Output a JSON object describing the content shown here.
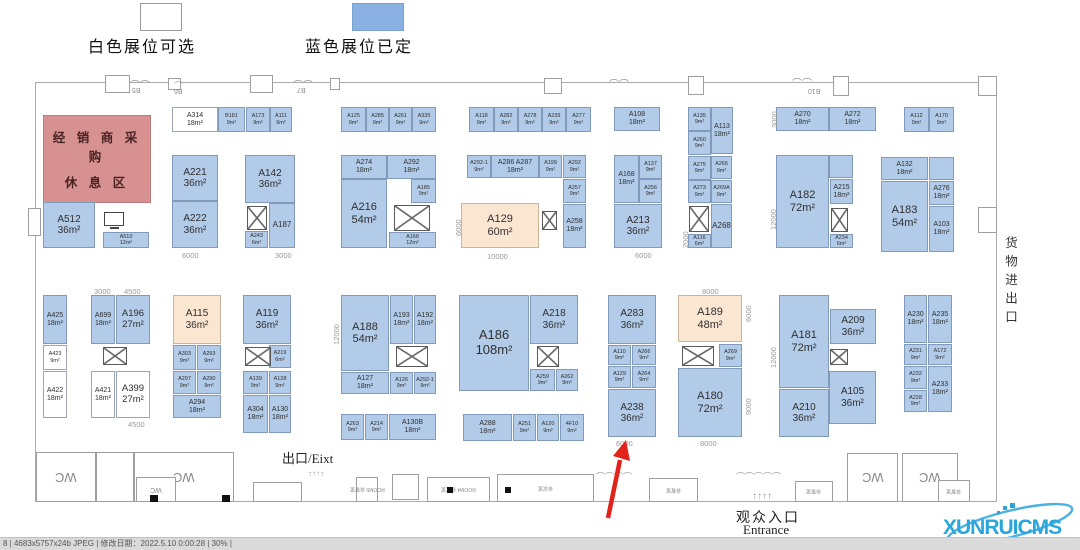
{
  "legend": {
    "available_label": "白色展位可选",
    "booked_label": "蓝色展位已定"
  },
  "colors": {
    "booked": "#b2cbe8",
    "available": "#ffffff",
    "special": "#fbe6d2",
    "rest_area": "#d79191",
    "arrow": "#e0241b",
    "logo": "#2ba6dc"
  },
  "rest_area": {
    "line1": "经 销 商 采 购",
    "line2": "休 息 区"
  },
  "texts": {
    "exit": "出口/Eixt",
    "entrance_cn": "观众入口",
    "entrance_en": "Entrance",
    "cargo": "货物进出口"
  },
  "logo": {
    "text": "XUNRUICMS"
  },
  "statusbar": {
    "text": "8 | 4683x5757x24b JPEG | 修改日期：2022.5.10 0:00:28 | 30% |"
  },
  "booths": [
    {
      "id": "A314",
      "a": "18m²",
      "x": 172,
      "y": 107,
      "w": 46,
      "h": 25,
      "t": "available"
    },
    {
      "id": "B181",
      "a": "9m²",
      "x": 218,
      "y": 107,
      "w": 27,
      "h": 25
    },
    {
      "id": "A173",
      "a": "9m²",
      "x": 246,
      "y": 107,
      "w": 24,
      "h": 25
    },
    {
      "id": "A111",
      "a": "9m²",
      "x": 270,
      "y": 107,
      "w": 22,
      "h": 25
    },
    {
      "id": "A125",
      "a": "9m²",
      "x": 341,
      "y": 107,
      "w": 25,
      "h": 25
    },
    {
      "id": "A285",
      "a": "9m²",
      "x": 366,
      "y": 107,
      "w": 23,
      "h": 25
    },
    {
      "id": "A261",
      "a": "9m²",
      "x": 389,
      "y": 107,
      "w": 23,
      "h": 25
    },
    {
      "id": "A335",
      "a": "9m²",
      "x": 412,
      "y": 107,
      "w": 24,
      "h": 25
    },
    {
      "id": "A118",
      "a": "9m²",
      "x": 469,
      "y": 107,
      "w": 25,
      "h": 25
    },
    {
      "id": "A282",
      "a": "9m²",
      "x": 494,
      "y": 107,
      "w": 24,
      "h": 25
    },
    {
      "id": "A278",
      "a": "9m²",
      "x": 518,
      "y": 107,
      "w": 24,
      "h": 25
    },
    {
      "id": "A239",
      "a": "9m²",
      "x": 542,
      "y": 107,
      "w": 24,
      "h": 25
    },
    {
      "id": "A277",
      "a": "9m²",
      "x": 566,
      "y": 107,
      "w": 25,
      "h": 25
    },
    {
      "id": "A108",
      "a": "18m²",
      "x": 614,
      "y": 107,
      "w": 46,
      "h": 24
    },
    {
      "id": "A135",
      "a": "9m²",
      "x": 688,
      "y": 107,
      "w": 23,
      "h": 24
    },
    {
      "id": "A113",
      "a": "18m²",
      "x": 711,
      "y": 107,
      "w": 22,
      "h": 47
    },
    {
      "id": "A260",
      "a": "9m²",
      "x": 688,
      "y": 131,
      "w": 23,
      "h": 24
    },
    {
      "id": "A270",
      "a": "18m²",
      "x": 776,
      "y": 107,
      "w": 53,
      "h": 24
    },
    {
      "id": "A272",
      "a": "18m²",
      "x": 829,
      "y": 107,
      "w": 47,
      "h": 24
    },
    {
      "id": "A112",
      "a": "9m²",
      "x": 904,
      "y": 107,
      "w": 25,
      "h": 25
    },
    {
      "id": "A170",
      "a": "9m²",
      "x": 929,
      "y": 107,
      "w": 25,
      "h": 25
    },
    {
      "id": "A512",
      "a": "36m²",
      "x": 43,
      "y": 202,
      "w": 52,
      "h": 46
    },
    {
      "id": "A510",
      "a": "12m²",
      "x": 103,
      "y": 232,
      "w": 46,
      "h": 16
    },
    {
      "id": "A221",
      "a": "36m²",
      "x": 172,
      "y": 155,
      "w": 46,
      "h": 46
    },
    {
      "id": "A222",
      "a": "36m²",
      "x": 172,
      "y": 201,
      "w": 46,
      "h": 47
    },
    {
      "id": "A142",
      "a": "36m²",
      "x": 245,
      "y": 155,
      "w": 50,
      "h": 48
    },
    {
      "id": "A243",
      "a": "6m²",
      "x": 245,
      "y": 231,
      "w": 23,
      "h": 17
    },
    {
      "id": "A187",
      "a": "",
      "x": 269,
      "y": 203,
      "w": 26,
      "h": 45
    },
    {
      "id": "A274",
      "a": "18m²",
      "x": 341,
      "y": 155,
      "w": 46,
      "h": 24
    },
    {
      "id": "A292",
      "a": "18m²",
      "x": 387,
      "y": 155,
      "w": 49,
      "h": 24
    },
    {
      "id": "A185",
      "a": "9m²",
      "x": 411,
      "y": 179,
      "w": 25,
      "h": 24
    },
    {
      "id": "A216",
      "a": "54m²",
      "x": 341,
      "y": 179,
      "w": 46,
      "h": 69
    },
    {
      "id": "A168",
      "a": "12m²",
      "x": 389,
      "y": 232,
      "w": 47,
      "h": 16
    },
    {
      "id": "A292-1",
      "a": "9m²",
      "x": 467,
      "y": 155,
      "w": 24,
      "h": 23
    },
    {
      "id": "A286 A287",
      "a": "18m²",
      "x": 491,
      "y": 155,
      "w": 48,
      "h": 23
    },
    {
      "id": "A199",
      "a": "9m²",
      "x": 539,
      "y": 155,
      "w": 23,
      "h": 23
    },
    {
      "id": "A292",
      "a": "9m²",
      "x": 563,
      "y": 155,
      "w": 23,
      "h": 23
    },
    {
      "id": "A257",
      "a": "9m²",
      "x": 563,
      "y": 179,
      "w": 23,
      "h": 24
    },
    {
      "id": "A258",
      "a": "18m²",
      "x": 563,
      "y": 204,
      "w": 23,
      "h": 44
    },
    {
      "id": "A129",
      "a": "60m²",
      "x": 461,
      "y": 203,
      "w": 78,
      "h": 45,
      "t": "special"
    },
    {
      "id": "A168",
      "a": "18m²",
      "x": 614,
      "y": 155,
      "w": 25,
      "h": 48
    },
    {
      "id": "A137",
      "a": "9m²",
      "x": 639,
      "y": 155,
      "w": 23,
      "h": 24
    },
    {
      "id": "A256",
      "a": "9m²",
      "x": 639,
      "y": 179,
      "w": 23,
      "h": 24
    },
    {
      "id": "A213",
      "a": "36m²",
      "x": 614,
      "y": 204,
      "w": 48,
      "h": 44
    },
    {
      "id": "A275",
      "a": "9m²",
      "x": 688,
      "y": 156,
      "w": 23,
      "h": 24
    },
    {
      "id": "A265",
      "a": "9m²",
      "x": 711,
      "y": 156,
      "w": 21,
      "h": 23
    },
    {
      "id": "A273",
      "a": "9m²",
      "x": 688,
      "y": 180,
      "w": 23,
      "h": 23
    },
    {
      "id": "A269A",
      "a": "9m²",
      "x": 711,
      "y": 180,
      "w": 21,
      "h": 23
    },
    {
      "id": "A268",
      "a": "",
      "x": 711,
      "y": 204,
      "w": 21,
      "h": 44
    },
    {
      "id": "A116",
      "a": "6m²",
      "x": 688,
      "y": 234,
      "w": 23,
      "h": 14
    },
    {
      "id": "A182",
      "a": "72m²",
      "x": 776,
      "y": 155,
      "w": 53,
      "h": 93
    },
    {
      "x": 829,
      "y": 155,
      "w": 24,
      "h": 23
    },
    {
      "id": "A215",
      "a": "18m²",
      "x": 830,
      "y": 179,
      "w": 23,
      "h": 25
    },
    {
      "id": "A234",
      "a": "6m²",
      "x": 830,
      "y": 234,
      "w": 23,
      "h": 14
    },
    {
      "id": "A132",
      "a": "18m²",
      "x": 881,
      "y": 157,
      "w": 47,
      "h": 23
    },
    {
      "x": 929,
      "y": 157,
      "w": 25,
      "h": 23
    },
    {
      "id": "A276",
      "a": "18m²",
      "x": 929,
      "y": 181,
      "w": 25,
      "h": 24
    },
    {
      "id": "A183",
      "a": "54m²",
      "x": 881,
      "y": 181,
      "w": 47,
      "h": 71
    },
    {
      "id": "A103",
      "a": "18m²",
      "x": 929,
      "y": 206,
      "w": 25,
      "h": 46
    },
    {
      "id": "A425",
      "a": "18m²",
      "x": 43,
      "y": 295,
      "w": 24,
      "h": 49
    },
    {
      "id": "A423",
      "a": "9m²",
      "x": 43,
      "y": 345,
      "w": 24,
      "h": 25,
      "t": "available"
    },
    {
      "id": "A422",
      "a": "18m²",
      "x": 43,
      "y": 371,
      "w": 24,
      "h": 47,
      "t": "available"
    },
    {
      "id": "A699",
      "a": "18m²",
      "x": 91,
      "y": 295,
      "w": 24,
      "h": 49
    },
    {
      "id": "A196",
      "a": "27m²",
      "x": 116,
      "y": 295,
      "w": 34,
      "h": 49
    },
    {
      "id": "A421",
      "a": "18m²",
      "x": 91,
      "y": 371,
      "w": 24,
      "h": 47,
      "t": "available"
    },
    {
      "id": "A399",
      "a": "27m²",
      "x": 116,
      "y": 371,
      "w": 34,
      "h": 47,
      "t": "available"
    },
    {
      "id": "A115",
      "a": "36m²",
      "x": 173,
      "y": 295,
      "w": 48,
      "h": 49,
      "t": "special"
    },
    {
      "id": "A303",
      "a": "9m²",
      "x": 173,
      "y": 345,
      "w": 23,
      "h": 25
    },
    {
      "id": "A293",
      "a": "9m²",
      "x": 197,
      "y": 345,
      "w": 24,
      "h": 25
    },
    {
      "id": "A297",
      "a": "9m²",
      "x": 173,
      "y": 371,
      "w": 23,
      "h": 23
    },
    {
      "id": "A290",
      "a": "9m²",
      "x": 197,
      "y": 371,
      "w": 24,
      "h": 23
    },
    {
      "id": "A294",
      "a": "18m²",
      "x": 173,
      "y": 395,
      "w": 48,
      "h": 23
    },
    {
      "id": "A119",
      "a": "36m²",
      "x": 243,
      "y": 295,
      "w": 48,
      "h": 49
    },
    {
      "id": "A219",
      "a": "6m²",
      "x": 269,
      "y": 345,
      "w": 22,
      "h": 23
    },
    {
      "id": "A139",
      "a": "9m²",
      "x": 243,
      "y": 371,
      "w": 25,
      "h": 23
    },
    {
      "id": "A128",
      "a": "9m²",
      "x": 269,
      "y": 371,
      "w": 22,
      "h": 23
    },
    {
      "id": "A304",
      "a": "18m²",
      "x": 243,
      "y": 395,
      "w": 25,
      "h": 38
    },
    {
      "id": "A130",
      "a": "18m²",
      "x": 269,
      "y": 395,
      "w": 22,
      "h": 38
    },
    {
      "id": "A188",
      "a": "54m²",
      "x": 341,
      "y": 295,
      "w": 48,
      "h": 76
    },
    {
      "id": "A193",
      "a": "18m²",
      "x": 390,
      "y": 295,
      "w": 23,
      "h": 49
    },
    {
      "id": "A192",
      "a": "18m²",
      "x": 414,
      "y": 295,
      "w": 22,
      "h": 49
    },
    {
      "id": "A127",
      "a": "18m²",
      "x": 341,
      "y": 372,
      "w": 48,
      "h": 22
    },
    {
      "id": "A126",
      "a": "9m²",
      "x": 390,
      "y": 372,
      "w": 23,
      "h": 22
    },
    {
      "id": "A292-1",
      "a": "9m²",
      "x": 414,
      "y": 372,
      "w": 22,
      "h": 22
    },
    {
      "id": "A263",
      "a": "9m²",
      "x": 341,
      "y": 414,
      "w": 23,
      "h": 26
    },
    {
      "id": "A214",
      "a": "9m²",
      "x": 365,
      "y": 414,
      "w": 23,
      "h": 26
    },
    {
      "id": "A130B",
      "a": "18m²",
      "x": 389,
      "y": 414,
      "w": 47,
      "h": 26
    },
    {
      "id": "A186",
      "a": "108m²",
      "x": 459,
      "y": 295,
      "w": 70,
      "h": 96
    },
    {
      "id": "A218",
      "a": "36m²",
      "x": 530,
      "y": 295,
      "w": 48,
      "h": 49
    },
    {
      "id": "A259",
      "a": "9m²",
      "x": 530,
      "y": 369,
      "w": 25,
      "h": 22
    },
    {
      "id": "A262",
      "a": "9m²",
      "x": 556,
      "y": 369,
      "w": 22,
      "h": 22
    },
    {
      "id": "A288",
      "a": "18m²",
      "x": 463,
      "y": 414,
      "w": 49,
      "h": 27
    },
    {
      "id": "A251",
      "a": "9m²",
      "x": 513,
      "y": 414,
      "w": 23,
      "h": 27
    },
    {
      "id": "A120",
      "a": "9m²",
      "x": 537,
      "y": 414,
      "w": 22,
      "h": 27
    },
    {
      "id": "4F10",
      "a": "9m²",
      "x": 560,
      "y": 414,
      "w": 24,
      "h": 27
    },
    {
      "id": "A283",
      "a": "36m²",
      "x": 608,
      "y": 295,
      "w": 48,
      "h": 49
    },
    {
      "id": "A110",
      "a": "9m²",
      "x": 608,
      "y": 345,
      "w": 23,
      "h": 20
    },
    {
      "id": "A266",
      "a": "9m²",
      "x": 632,
      "y": 345,
      "w": 24,
      "h": 20
    },
    {
      "id": "A129",
      "a": "9m²",
      "x": 608,
      "y": 366,
      "w": 23,
      "h": 22
    },
    {
      "id": "A264",
      "a": "9m²",
      "x": 632,
      "y": 366,
      "w": 24,
      "h": 22
    },
    {
      "id": "A238",
      "a": "36m²",
      "x": 608,
      "y": 389,
      "w": 48,
      "h": 48
    },
    {
      "id": "A189",
      "a": "48m²",
      "x": 678,
      "y": 295,
      "w": 64,
      "h": 47,
      "t": "special"
    },
    {
      "id": "A269",
      "a": "9m²",
      "x": 719,
      "y": 344,
      "w": 23,
      "h": 23
    },
    {
      "id": "A180",
      "a": "72m²",
      "x": 678,
      "y": 368,
      "w": 64,
      "h": 69
    },
    {
      "id": "A181",
      "a": "72m²",
      "x": 779,
      "y": 295,
      "w": 50,
      "h": 93
    },
    {
      "id": "A209",
      "a": "36m²",
      "x": 830,
      "y": 309,
      "w": 46,
      "h": 35
    },
    {
      "id": "A210",
      "a": "36m²",
      "x": 779,
      "y": 389,
      "w": 50,
      "h": 48
    },
    {
      "id": "A105",
      "a": "36m²",
      "x": 829,
      "y": 371,
      "w": 47,
      "h": 53
    },
    {
      "id": "A230",
      "a": "18m²",
      "x": 904,
      "y": 295,
      "w": 23,
      "h": 48
    },
    {
      "id": "A235",
      "a": "18m²",
      "x": 928,
      "y": 295,
      "w": 24,
      "h": 48
    },
    {
      "id": "A231",
      "a": "9m²",
      "x": 904,
      "y": 344,
      "w": 23,
      "h": 21
    },
    {
      "id": "A172",
      "a": "9m²",
      "x": 928,
      "y": 344,
      "w": 24,
      "h": 21
    },
    {
      "id": "A232",
      "a": "9m²",
      "x": 904,
      "y": 366,
      "w": 23,
      "h": 23
    },
    {
      "id": "A228",
      "a": "9m²",
      "x": 904,
      "y": 390,
      "w": 23,
      "h": 22
    },
    {
      "id": "A233",
      "a": "18m²",
      "x": 928,
      "y": 366,
      "w": 24,
      "h": 46
    }
  ],
  "icons": [
    {
      "t": "mon",
      "x": 104,
      "y": 212,
      "w": 20,
      "h": 14
    },
    {
      "t": "cb",
      "x": 247,
      "y": 206,
      "w": 20,
      "h": 24
    },
    {
      "t": "cb",
      "x": 394,
      "y": 205,
      "w": 36,
      "h": 26
    },
    {
      "t": "cb",
      "x": 542,
      "y": 211,
      "w": 15,
      "h": 19
    },
    {
      "t": "cb",
      "x": 689,
      "y": 206,
      "w": 20,
      "h": 26
    },
    {
      "t": "cb",
      "x": 831,
      "y": 208,
      "w": 17,
      "h": 24
    },
    {
      "t": "cb",
      "x": 103,
      "y": 347,
      "w": 24,
      "h": 18
    },
    {
      "t": "cb",
      "x": 245,
      "y": 347,
      "w": 26,
      "h": 19
    },
    {
      "t": "cb",
      "x": 396,
      "y": 346,
      "w": 32,
      "h": 21
    },
    {
      "t": "cb",
      "x": 537,
      "y": 346,
      "w": 22,
      "h": 21
    },
    {
      "t": "cb",
      "x": 682,
      "y": 346,
      "w": 32,
      "h": 20
    },
    {
      "t": "cb",
      "x": 830,
      "y": 349,
      "w": 18,
      "h": 16
    }
  ],
  "dims": [
    {
      "v": "6000",
      "x": 182,
      "y": 251
    },
    {
      "v": "3000",
      "x": 275,
      "y": 251
    },
    {
      "v": "10000",
      "x": 487,
      "y": 252
    },
    {
      "v": "6000",
      "x": 454,
      "y": 236,
      "r": 1
    },
    {
      "v": "6000",
      "x": 635,
      "y": 251
    },
    {
      "v": "2000",
      "x": 681,
      "y": 248,
      "r": 1
    },
    {
      "v": "3000",
      "x": 770,
      "y": 128,
      "r": 1
    },
    {
      "v": "12000",
      "x": 769,
      "y": 230,
      "r": 1
    },
    {
      "v": "3000",
      "x": 94,
      "y": 287
    },
    {
      "v": "4500",
      "x": 124,
      "y": 287
    },
    {
      "v": "4500",
      "x": 128,
      "y": 420
    },
    {
      "v": "12000",
      "x": 332,
      "y": 345,
      "r": 1
    },
    {
      "v": "8000",
      "x": 702,
      "y": 287
    },
    {
      "v": "6000",
      "x": 744,
      "y": 322,
      "r": 1
    },
    {
      "v": "9000",
      "x": 744,
      "y": 415,
      "r": 1
    },
    {
      "v": "8000",
      "x": 700,
      "y": 439
    },
    {
      "v": "6000",
      "x": 616,
      "y": 439
    },
    {
      "v": "12000",
      "x": 769,
      "y": 368,
      "r": 1
    }
  ],
  "pillars": [
    {
      "x": 105,
      "y": 75,
      "w": 25,
      "h": 18
    },
    {
      "x": 168,
      "y": 78,
      "w": 13,
      "h": 12
    },
    {
      "x": 250,
      "y": 75,
      "w": 23,
      "h": 18
    },
    {
      "x": 330,
      "y": 78,
      "w": 10,
      "h": 12
    },
    {
      "x": 544,
      "y": 78,
      "w": 18,
      "h": 16
    },
    {
      "x": 688,
      "y": 76,
      "w": 16,
      "h": 19
    },
    {
      "x": 833,
      "y": 76,
      "w": 16,
      "h": 20
    },
    {
      "x": 978,
      "y": 76,
      "w": 19,
      "h": 20
    },
    {
      "x": 28,
      "y": 208,
      "w": 13,
      "h": 28
    },
    {
      "x": 978,
      "y": 207,
      "w": 19,
      "h": 26
    }
  ],
  "wall_labels": [
    {
      "v": "B5",
      "x": 132,
      "y": 86
    },
    {
      "v": "B6",
      "x": 174,
      "y": 87
    },
    {
      "v": "B7",
      "x": 297,
      "y": 86
    },
    {
      "v": "B10",
      "x": 808,
      "y": 87
    }
  ],
  "rooms": [
    {
      "l": "WC",
      "x": 36,
      "y": 452,
      "w": 60,
      "h": 50,
      "f": 1,
      "fs": 13
    },
    {
      "l": "",
      "x": 96,
      "y": 452,
      "w": 38,
      "h": 50
    },
    {
      "l": "WC",
      "x": 134,
      "y": 452,
      "w": 100,
      "h": 50,
      "f": 1,
      "fs": 13
    },
    {
      "l": "WC",
      "x": 136,
      "y": 477,
      "w": 40,
      "h": 25,
      "f": 1,
      "fs": 7
    },
    {
      "l": "",
      "x": 253,
      "y": 482,
      "w": 49,
      "h": 20
    },
    {
      "l": "ROOM5 会客室",
      "x": 356,
      "y": 477,
      "w": 22,
      "h": 25,
      "f": 1,
      "fs": 5
    },
    {
      "l": "",
      "x": 392,
      "y": 474,
      "w": 27,
      "h": 26
    },
    {
      "l": "ROOM4 会议室",
      "x": 427,
      "y": 477,
      "w": 63,
      "h": 25,
      "f": 1,
      "fs": 5
    },
    {
      "l": "会议室",
      "x": 497,
      "y": 474,
      "w": 97,
      "h": 28,
      "f": 1,
      "fs": 5
    },
    {
      "l": "会客室",
      "x": 649,
      "y": 478,
      "w": 49,
      "h": 24,
      "f": 1,
      "fs": 5
    },
    {
      "l": "会客室",
      "x": 795,
      "y": 481,
      "w": 38,
      "h": 21,
      "f": 1,
      "fs": 5
    },
    {
      "l": "WC",
      "x": 847,
      "y": 453,
      "w": 51,
      "h": 49,
      "f": 1,
      "fs": 13
    },
    {
      "l": "WC",
      "x": 902,
      "y": 453,
      "w": 56,
      "h": 49,
      "f": 1,
      "fs": 13
    },
    {
      "l": "会客室",
      "x": 938,
      "y": 480,
      "w": 32,
      "h": 22,
      "f": 1,
      "fs": 5
    }
  ],
  "marks": [
    {
      "x": 447,
      "y": 487,
      "w": 6,
      "h": 6
    },
    {
      "x": 505,
      "y": 487,
      "w": 6,
      "h": 6
    },
    {
      "x": 150,
      "y": 495,
      "w": 8,
      "h": 7
    },
    {
      "x": 222,
      "y": 495,
      "w": 8,
      "h": 7
    }
  ],
  "decos": [
    {
      "v": "︵︵",
      "x": 130,
      "y": 70,
      "fs": 10
    },
    {
      "v": "︵",
      "x": 174,
      "y": 73,
      "fs": 9
    },
    {
      "v": "︵︵",
      "x": 293,
      "y": 70,
      "fs": 10
    },
    {
      "v": "︵︵",
      "x": 609,
      "y": 69,
      "fs": 10
    },
    {
      "v": "︵︵",
      "x": 792,
      "y": 68,
      "fs": 10
    },
    {
      "v": "⌒⌒⌒⌒",
      "x": 596,
      "y": 470,
      "fs": 9
    },
    {
      "v": "⌒⌒⌒⌒⌒",
      "x": 736,
      "y": 470,
      "fs": 9
    },
    {
      "v": "↑↑↑↑",
      "x": 308,
      "y": 469,
      "fs": 8
    },
    {
      "v": "↑↑↑↑",
      "x": 752,
      "y": 491,
      "fs": 10
    }
  ]
}
